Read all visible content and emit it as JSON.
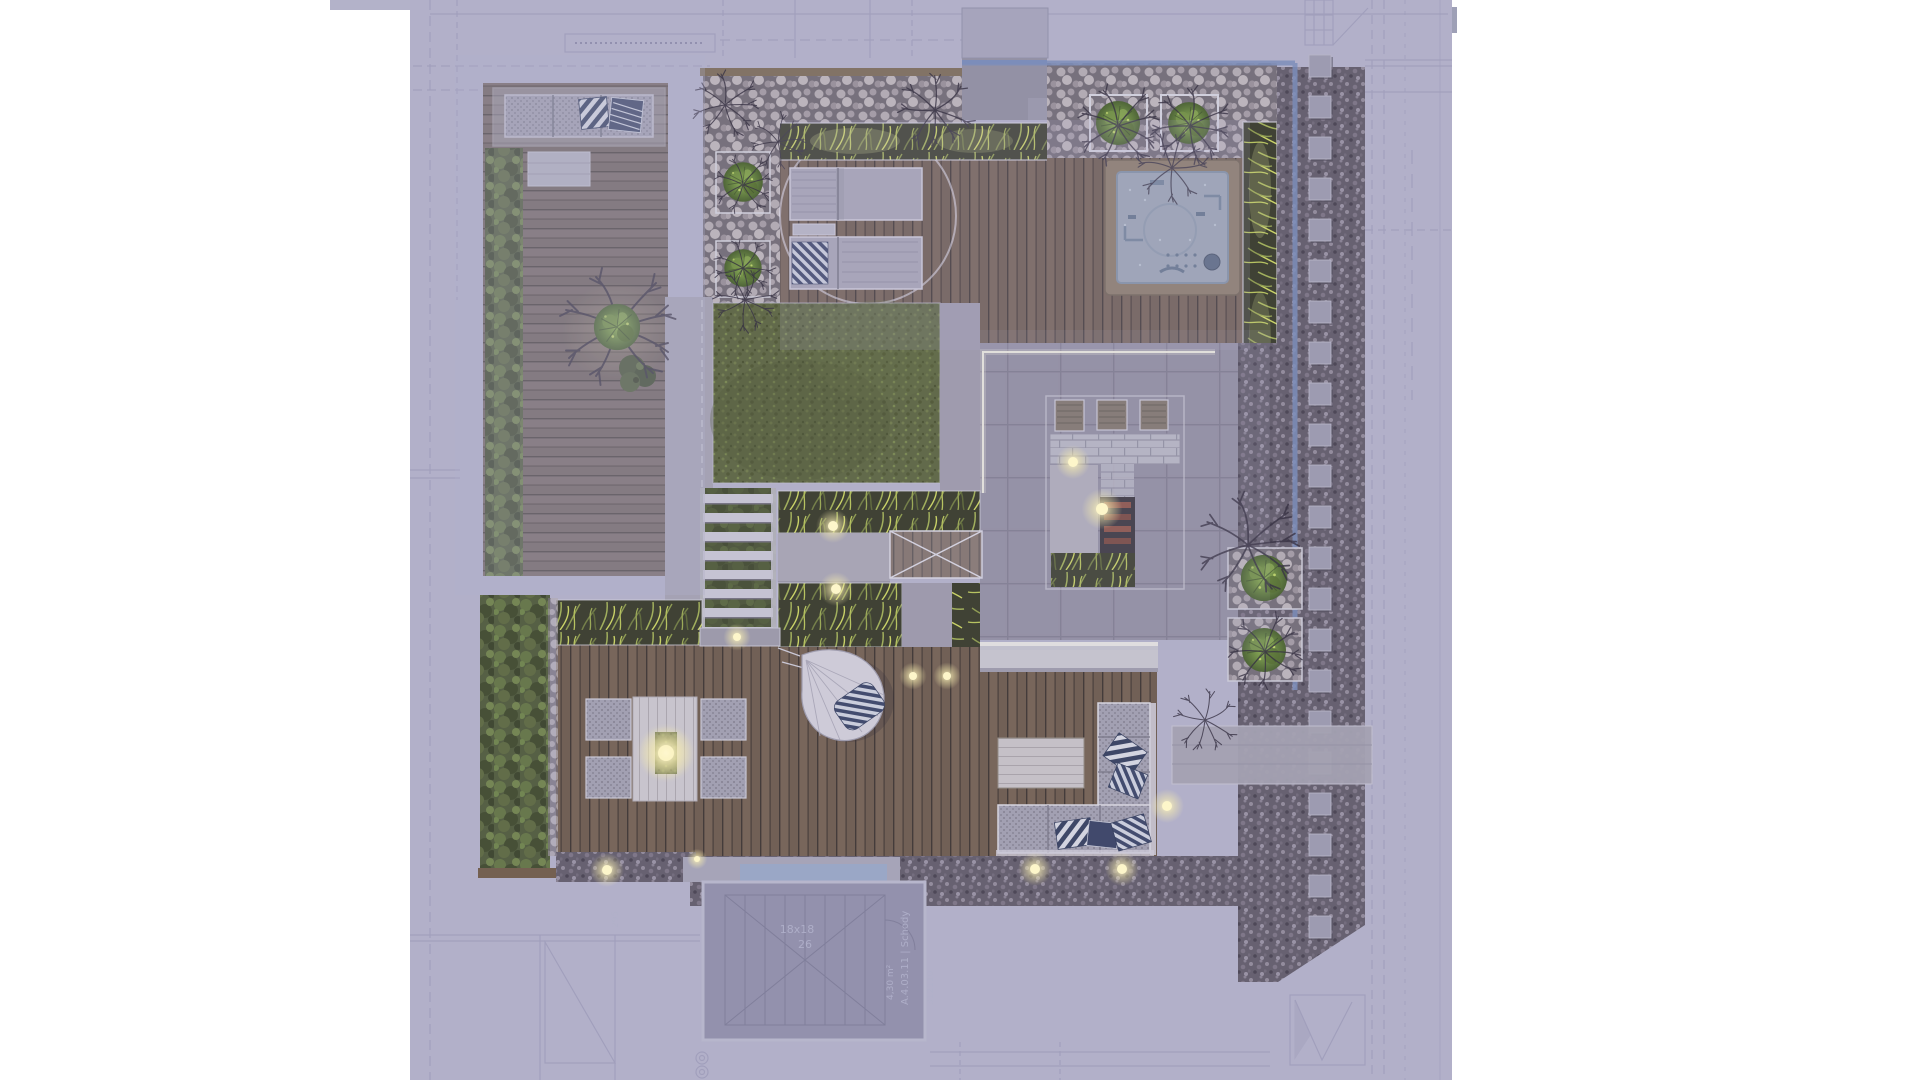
{
  "scene": {
    "kind": "rooftop-terrace-landscape-plan-render",
    "annotations": {
      "stair_dim": "18x18",
      "stair_count": "26",
      "stair_room": "A.4.03.11 | Schody",
      "stair_area": "4,30 m²",
      "stair_code": "312110",
      "dim_left": "295"
    },
    "colors": {
      "blueprint_lavender": "#b3b2c9",
      "blueprint_line": "#8f8eae",
      "deck_wood": "#6f5b49",
      "deck_muted": "#766c6d",
      "lawn_green": "#566036",
      "grass_blade": "#cdd957",
      "hedge_green": "#47542f",
      "hot_tub_water": "#99a5b2",
      "wall_blue": "#7489b7",
      "glow_warm": "#fff7d0",
      "paver_gray": "#8f8b9c",
      "gravel_dark": "#5b5662",
      "pebble_light": "#b3acb0",
      "pillow_navy": "#2c3757",
      "furniture_gray": "#a09fae"
    }
  }
}
